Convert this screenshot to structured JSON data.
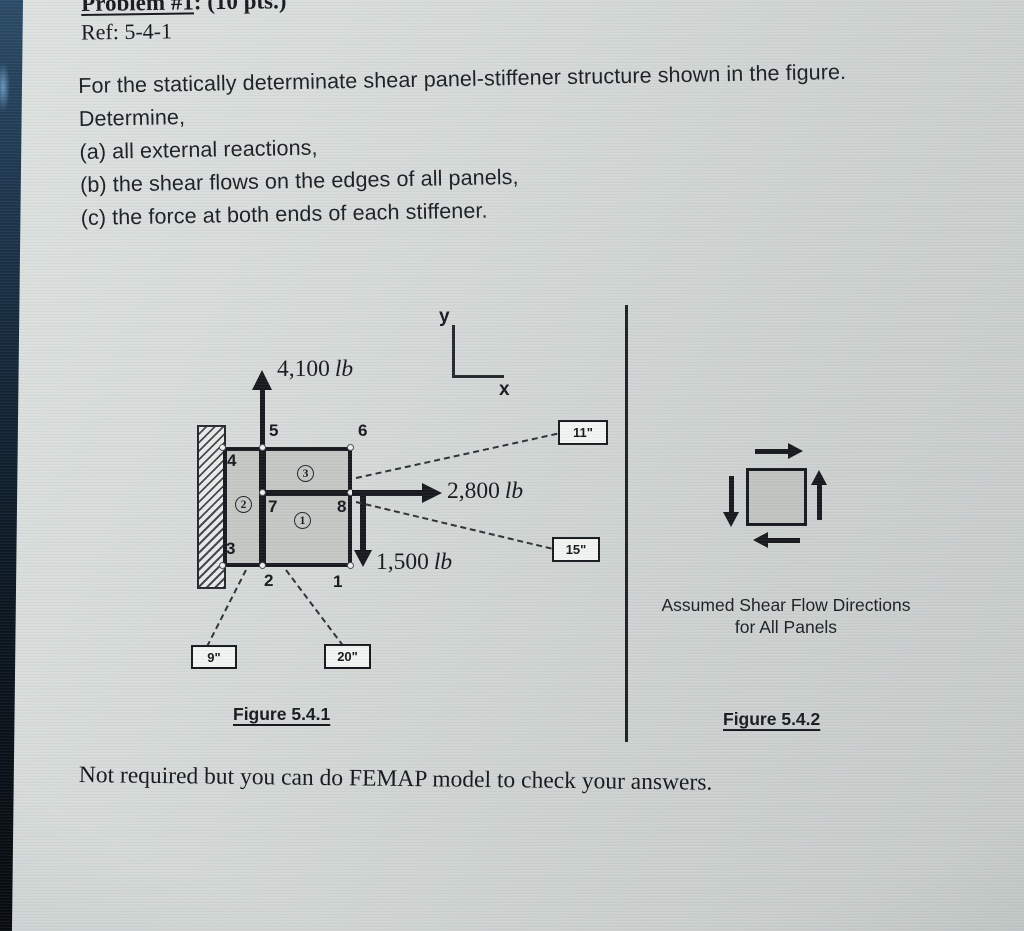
{
  "header": {
    "title": "Problem #1",
    "suffix": ": (10 pts.)",
    "ref": "Ref: 5-4-1"
  },
  "problem": {
    "line1": "For the statically determinate shear panel-stiffener structure shown in the figure.",
    "line2": "Determine,",
    "line3": "(a) all external reactions,",
    "line4": "(b) the shear flows on the edges of all panels,",
    "line5": "(c) the force at both ends of each stiffener."
  },
  "figure1": {
    "caption": "Figure 5.4.1",
    "axis_y": "y",
    "axis_x": "x",
    "force_up": {
      "value": "4,100",
      "unit": "lb"
    },
    "force_right": {
      "value": "2,800",
      "unit": "lb"
    },
    "force_down": {
      "value": "1,500",
      "unit": "lb"
    },
    "nodes": {
      "n1": "1",
      "n2": "2",
      "n3": "3",
      "n4": "4",
      "n5": "5",
      "n6": "6",
      "n7": "7",
      "n8": "8"
    },
    "panels": {
      "p1": "1",
      "p2": "2",
      "p3": "3"
    },
    "dims": {
      "d11": "11\"",
      "d15": "15\"",
      "d9": "9\"",
      "d20": "20\""
    }
  },
  "figure2": {
    "caption": "Figure 5.4.2",
    "note_line1": "Assumed Shear Flow Directions",
    "note_line2": "for All Panels"
  },
  "footer_note": "Not required but you can do FEMAP model to check your answers.",
  "colors": {
    "screen_bg": "#d3d8d7",
    "panel_fill": "#c4c8c5",
    "ink": "#15181c",
    "bezel_top": "#2a4a66",
    "bezel_bottom": "#06090d",
    "dim_box_fill": "#f2f4f2"
  }
}
